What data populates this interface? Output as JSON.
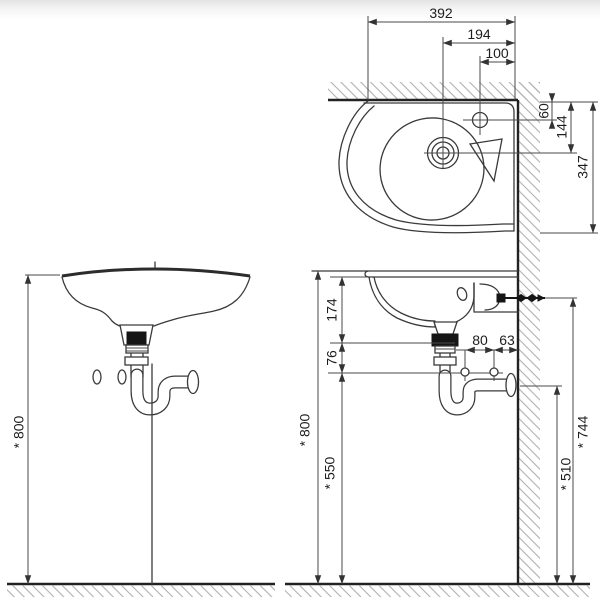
{
  "drawing": {
    "type": "washbasin-installation-technical-drawing",
    "units": "mm",
    "line_color": "#3a3a3a",
    "hatch_color": "#b0b0b0",
    "background_top_fade": "#e3e3e3"
  },
  "plan_view": {
    "dims": {
      "overall_width": "392",
      "drain_to_wall": "194",
      "tap_hole_to_wall": "100",
      "tap_hole_from_wall": "60",
      "drain_from_wall": "144",
      "overall_depth": "347"
    }
  },
  "front_view": {
    "dims": {
      "rim_height": "* 800"
    }
  },
  "side_view": {
    "dims": {
      "rim_to_trap_nut": "174",
      "nut_to_fixing_holes": "76",
      "fixing_hole_spacing": "80",
      "fixing_hole_to_wall": "63",
      "rim_height": "* 800",
      "fixing_holes_height": "* 550",
      "outlet_height": "* 510",
      "bolt_height": "* 744"
    }
  }
}
